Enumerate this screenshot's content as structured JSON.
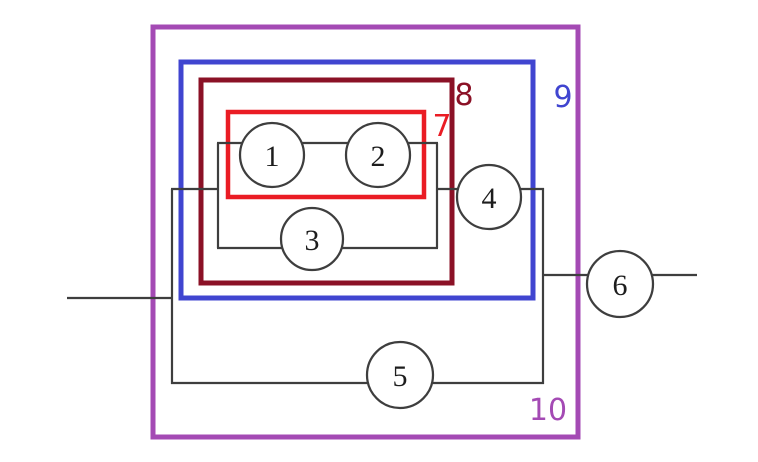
{
  "diagram": {
    "kind": "series-parallel block diagram",
    "background": "#ffffff",
    "colors": {
      "wire": "#3e3e3e",
      "node_stroke": "#3e3e3e",
      "node_fill": "#ffffff"
    },
    "nodes": [
      {
        "label": "1"
      },
      {
        "label": "2"
      },
      {
        "label": "3"
      },
      {
        "label": "4"
      },
      {
        "label": "5"
      },
      {
        "label": "6"
      }
    ],
    "groups": [
      {
        "label": "7",
        "color": "#ea1c24",
        "contains": [
          "1",
          "2"
        ]
      },
      {
        "label": "8",
        "color": "#8b1126",
        "contains": [
          "1",
          "2",
          "3"
        ]
      },
      {
        "label": "9",
        "color": "#4045d0",
        "contains": [
          "1",
          "2",
          "3",
          "4"
        ]
      },
      {
        "label": "10",
        "color": "#a44ab4",
        "contains": [
          "1",
          "2",
          "3",
          "4",
          "5"
        ]
      }
    ]
  }
}
